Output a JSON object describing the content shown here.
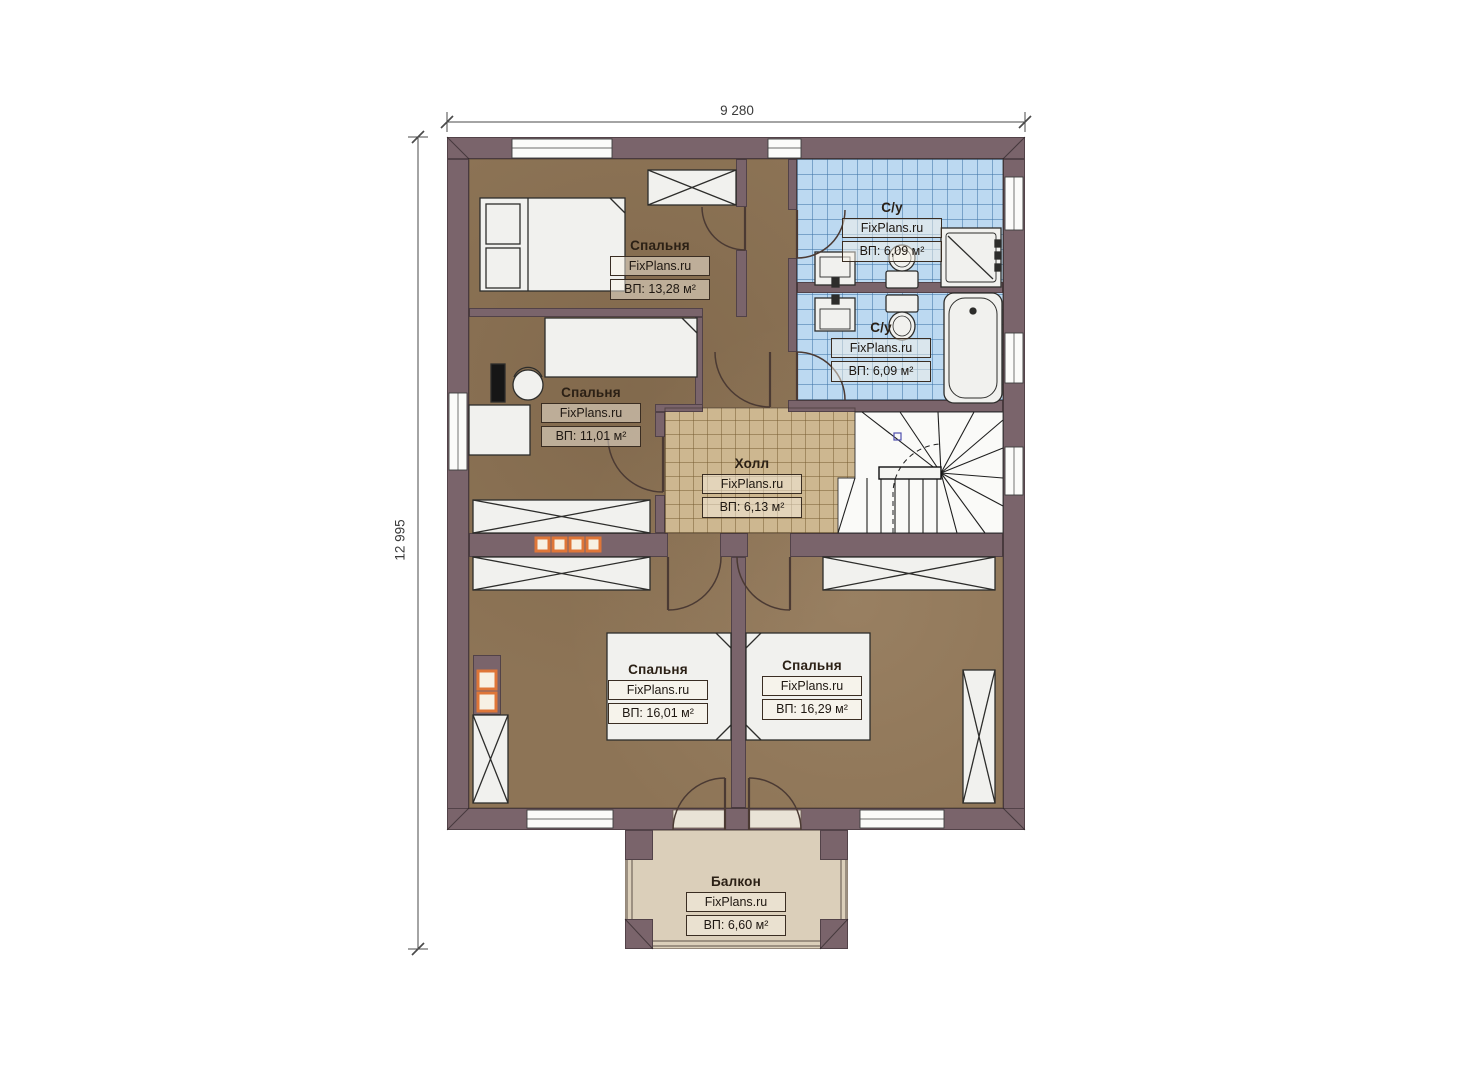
{
  "plan": {
    "title": "Floor plan, second storey",
    "dimensions": {
      "width_label": "9 280",
      "height_label": "12 995"
    },
    "brand": "FixPlans.ru",
    "rooms": [
      {
        "id": "bedroom-top-left",
        "name": "Спальня",
        "brand": "FixPlans.ru",
        "area": "ВП: 13,28 м²"
      },
      {
        "id": "bedroom-mid-left",
        "name": "Спальня",
        "brand": "FixPlans.ru",
        "area": "ВП: 11,01 м²"
      },
      {
        "id": "bathroom-top",
        "name": "С/у",
        "brand": "FixPlans.ru",
        "area": "ВП: 6,09 м²"
      },
      {
        "id": "bathroom-bottom",
        "name": "С/у",
        "brand": "FixPlans.ru",
        "area": "ВП: 6,09 м²"
      },
      {
        "id": "hall",
        "name": "Холл",
        "brand": "FixPlans.ru",
        "area": "ВП: 6,13 м²"
      },
      {
        "id": "bedroom-bottom-left",
        "name": "Спальня",
        "brand": "FixPlans.ru",
        "area": "ВП: 16,01 м²"
      },
      {
        "id": "bedroom-bottom-right",
        "name": "Спальня",
        "brand": "FixPlans.ru",
        "area": "ВП: 16,29 м²"
      },
      {
        "id": "balcony",
        "name": "Балкон",
        "brand": "FixPlans.ru",
        "area": "ВП: 6,60 м²"
      }
    ],
    "colors": {
      "wall": "#7a646b",
      "wood_floor": "#8d7456",
      "bath_tile": "#bcd9f1",
      "hall_tile": "#cdb790",
      "balcony_floor": "#dbcfba",
      "accent_orange": "#df7638"
    }
  }
}
